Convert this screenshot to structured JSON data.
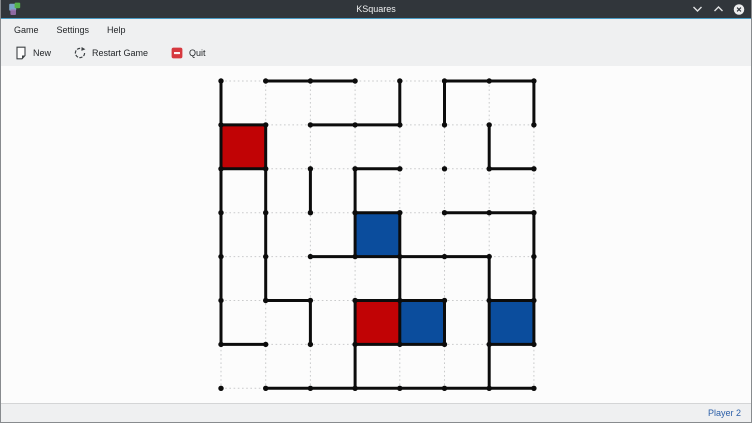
{
  "window": {
    "title": "KSquares",
    "titlebar_bg": "#31363b",
    "accent_line_color": "#4a9cc4",
    "icons": {
      "app": "ksquares-logo",
      "minimize": "chevron-down",
      "maximize": "chevron-up",
      "close": "circle-x"
    }
  },
  "menubar": {
    "items": [
      "Game",
      "Settings",
      "Help"
    ]
  },
  "toolbar": {
    "buttons": [
      {
        "label": "New",
        "icon": "document-new"
      },
      {
        "label": "Restart Game",
        "icon": "restart-circular-arrow"
      },
      {
        "label": "Quit",
        "icon": "application-exit"
      }
    ]
  },
  "statusbar": {
    "current_turn": "Player 2",
    "text_color": "#2c5fa8"
  },
  "board": {
    "cols": 8,
    "rows": 8,
    "origin_x": 220,
    "origin_y": 15,
    "dx": 44.7,
    "dy": 43.9,
    "line_color": "#0c0c0c",
    "line_width": 3,
    "dot_color": "#0c0c0c",
    "dot_radius": 2.7,
    "grid_color": "#c9cacb",
    "colors": {
      "red": "#c10305",
      "blue": "#0b4d9d"
    },
    "h_segments": [
      [
        0,
        1
      ],
      [
        0,
        2
      ],
      [
        0,
        5
      ],
      [
        0,
        6
      ],
      [
        1,
        0
      ],
      [
        1,
        2
      ],
      [
        1,
        3
      ],
      [
        2,
        0
      ],
      [
        2,
        3
      ],
      [
        2,
        6
      ],
      [
        3,
        3
      ],
      [
        3,
        5
      ],
      [
        3,
        6
      ],
      [
        4,
        2
      ],
      [
        4,
        3
      ],
      [
        4,
        4
      ],
      [
        4,
        5
      ],
      [
        5,
        1
      ],
      [
        5,
        3
      ],
      [
        5,
        4
      ],
      [
        5,
        6
      ],
      [
        6,
        0
      ],
      [
        6,
        3
      ],
      [
        6,
        4
      ],
      [
        6,
        6
      ],
      [
        7,
        1
      ],
      [
        7,
        2
      ],
      [
        7,
        3
      ],
      [
        7,
        4
      ],
      [
        7,
        5
      ],
      [
        7,
        6
      ]
    ],
    "v_segments": [
      [
        0,
        0
      ],
      [
        0,
        1
      ],
      [
        0,
        2
      ],
      [
        0,
        3
      ],
      [
        0,
        4
      ],
      [
        0,
        5
      ],
      [
        1,
        1
      ],
      [
        1,
        2
      ],
      [
        1,
        3
      ],
      [
        1,
        4
      ],
      [
        2,
        2
      ],
      [
        2,
        5
      ],
      [
        3,
        2
      ],
      [
        3,
        3
      ],
      [
        3,
        5
      ],
      [
        3,
        6
      ],
      [
        4,
        0
      ],
      [
        4,
        3
      ],
      [
        4,
        4
      ],
      [
        4,
        5
      ],
      [
        5,
        0
      ],
      [
        5,
        5
      ],
      [
        6,
        1
      ],
      [
        6,
        4
      ],
      [
        6,
        5
      ],
      [
        6,
        6
      ],
      [
        7,
        0
      ],
      [
        7,
        3
      ],
      [
        7,
        4
      ],
      [
        7,
        5
      ]
    ],
    "filled_cells": [
      {
        "col": 0,
        "row": 1,
        "color": "red"
      },
      {
        "col": 3,
        "row": 3,
        "color": "blue"
      },
      {
        "col": 3,
        "row": 5,
        "color": "red"
      },
      {
        "col": 4,
        "row": 5,
        "color": "blue"
      },
      {
        "col": 6,
        "row": 5,
        "color": "blue"
      }
    ]
  }
}
